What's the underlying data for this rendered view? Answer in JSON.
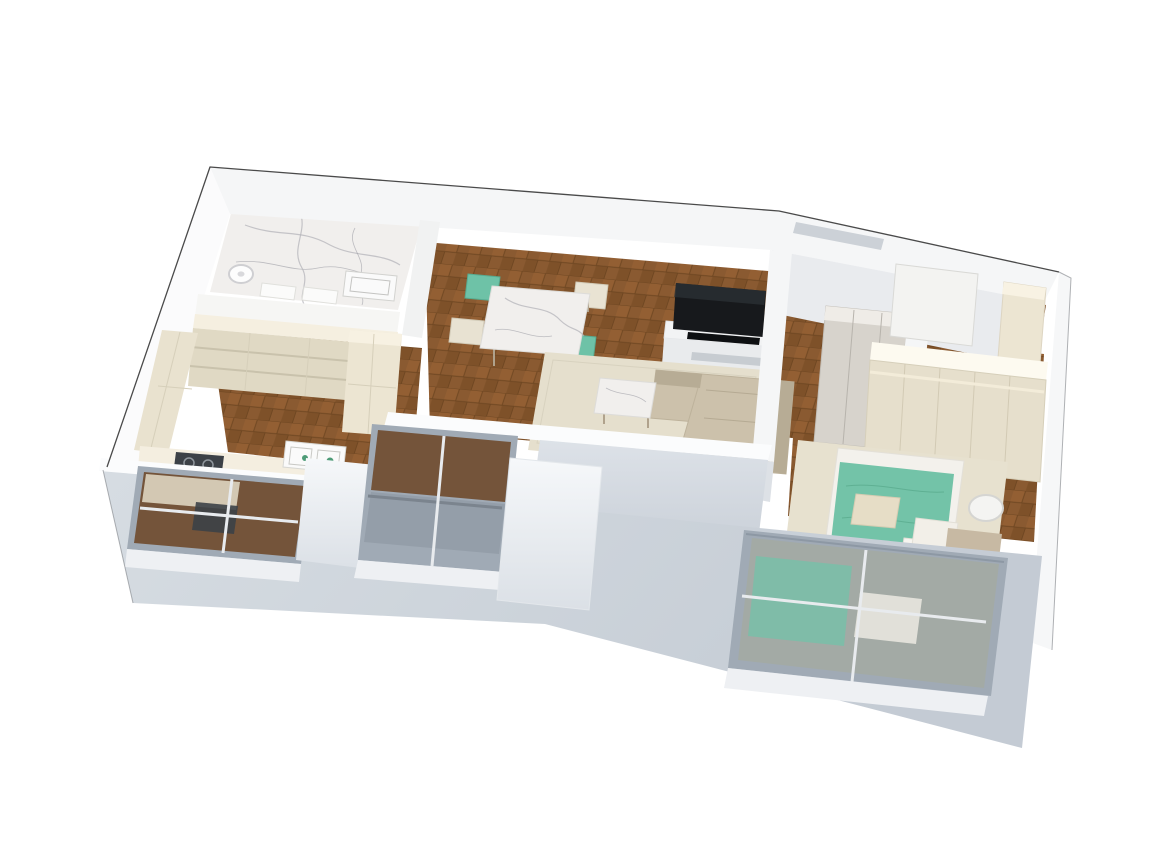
{
  "scene": {
    "kind": "3d-isometric-cutaway-floor-plan-render",
    "background": "#ffffff",
    "rooms": [
      {
        "id": "bathroom",
        "floor": "white-marble",
        "items": [
          "rain-shower-head",
          "wall-sink",
          "toilet-block",
          "storage-block"
        ]
      },
      {
        "id": "kitchen",
        "floor": "wood-parquet",
        "items": [
          "open-shelving-run",
          "tall-pantry-column",
          "west-cabinet-run",
          "south-counter",
          "double-sink",
          "gas-cooktop",
          "window"
        ]
      },
      {
        "id": "dining-area",
        "floor": "wood-parquet",
        "items": [
          "marble-dining-table",
          "teal-chair-nw",
          "cream-chair-w",
          "cream-chair-ne",
          "teal-chair-se"
        ]
      },
      {
        "id": "living-room",
        "floor": "wood-parquet",
        "items": [
          "tv",
          "tv-console",
          "area-rug",
          "l-shaped-sofa",
          "marble-coffee-table",
          "floor-to-ceiling-window"
        ]
      },
      {
        "id": "hallway",
        "floor": "wood-parquet",
        "items": [
          "sliding-door-closet",
          "corridor-wall"
        ]
      },
      {
        "id": "entrance",
        "floor": "wood-parquet",
        "items": [
          "door-niche",
          "open-door-panel",
          "tall-cream-cabinet"
        ]
      },
      {
        "id": "bedroom",
        "floor": "wood-parquet",
        "items": [
          "wardrobe",
          "area-rug",
          "double-bed",
          "teal-duvet",
          "white-pillows",
          "cream-accent-pillow",
          "headboard-bench",
          "round-side-table",
          "window"
        ]
      }
    ],
    "palette": {
      "wall_white": "#f5f6f7",
      "wall_cap_white": "#fbfcfd",
      "wall_face_gray": "#d4d9e0",
      "facade_gray": "#cbd2da",
      "niche_gray": "#ccd1d7",
      "wood_floor": "#8a5a31",
      "wood_floor_dark": "#774c26",
      "marble_white": "#f1efed",
      "cabinet_cream": "#e9e2cf",
      "cabinet_cream_top": "#f5efe0",
      "cabinet_cream_face": "#e0d9c4",
      "pantry_cream": "#ece5d2",
      "counter_top_cream": "#f4eee0",
      "teal_accent": "#6ec2a7",
      "teal_duvet": "#73c3a8",
      "sofa_beige": "#ccc1ab",
      "sofa_beige_dark": "#b7ac95",
      "rug_beige": "#e5dfcd",
      "bedroom_rug_beige": "#e7e1cf",
      "tv_black": "#17191c",
      "console_white": "#f2f3f4",
      "window_frame_gray": "#a0aab5",
      "glass_gray": "#949ea9",
      "glass_interior_brown": "#74543a",
      "wardrobe_cream": "#e6dfcc",
      "headboard_tan": "#c7b9a3",
      "mattress_white": "#f3f1ec",
      "sidetable_white": "#f4f4f2",
      "stove_dark": "#3c4147",
      "sink_white": "#fafafa"
    }
  }
}
